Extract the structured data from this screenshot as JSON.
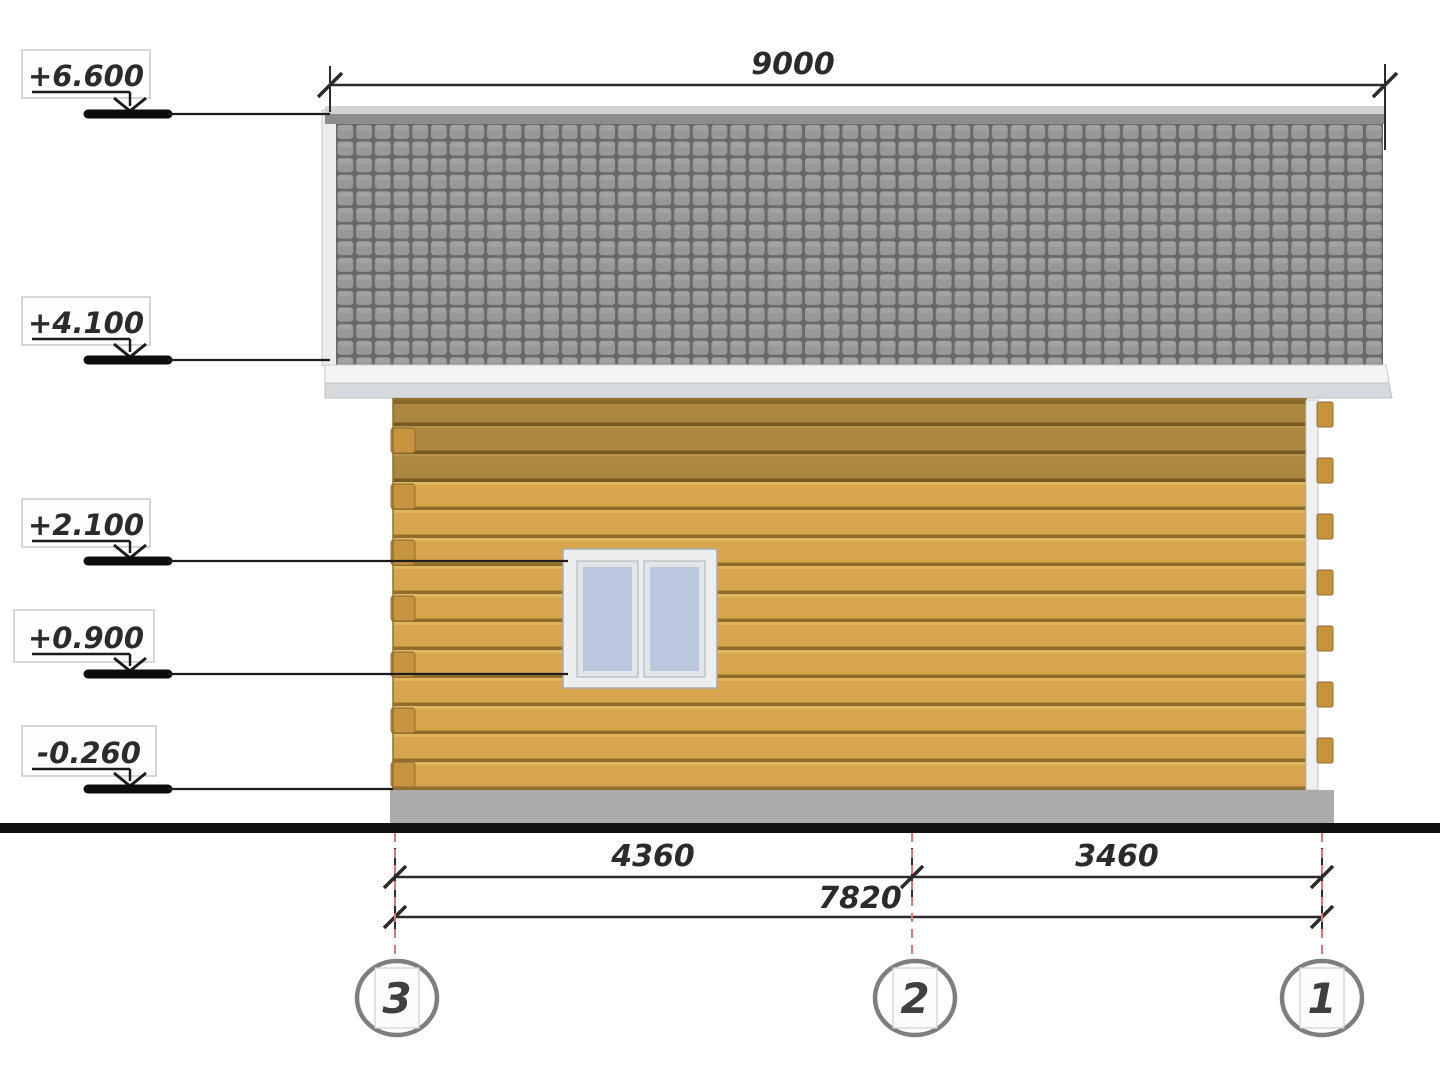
{
  "drawing": {
    "kind": "house side elevation (axes 3-2-1)",
    "background": "#ffffff"
  },
  "elevation_markers": [
    {
      "label": "+6.600"
    },
    {
      "label": "+4.100"
    },
    {
      "label": "+2.100"
    },
    {
      "label": "+0.900"
    },
    {
      "label": "-0.260"
    }
  ],
  "dimensions": {
    "top_width": "9000",
    "axis_3_to_2": "4360",
    "axis_2_to_1": "3460",
    "total": "7820"
  },
  "axes": [
    {
      "label": "3"
    },
    {
      "label": "2"
    },
    {
      "label": "1"
    }
  ],
  "colors": {
    "ink": "#1c1c1c",
    "roof_tile": "#989898",
    "roof_grid": "#686868",
    "roof_ridge": "#8c8c8c",
    "roof_top_edge": "#d2d2d2",
    "fascia_white": "#f4f4f4",
    "fascia_gray": "#d7dadc",
    "wall_light": "#d6a54e",
    "wall_shadow": "#ab8740",
    "plank_gap": "#8f6e2d",
    "log_end": "#c6933f",
    "corner_board": "#eef0f1",
    "foundation": "#ababab",
    "window_frame": "#eceef0",
    "window_glass": "#bac7dc",
    "axis_line_red": "#e57373"
  }
}
